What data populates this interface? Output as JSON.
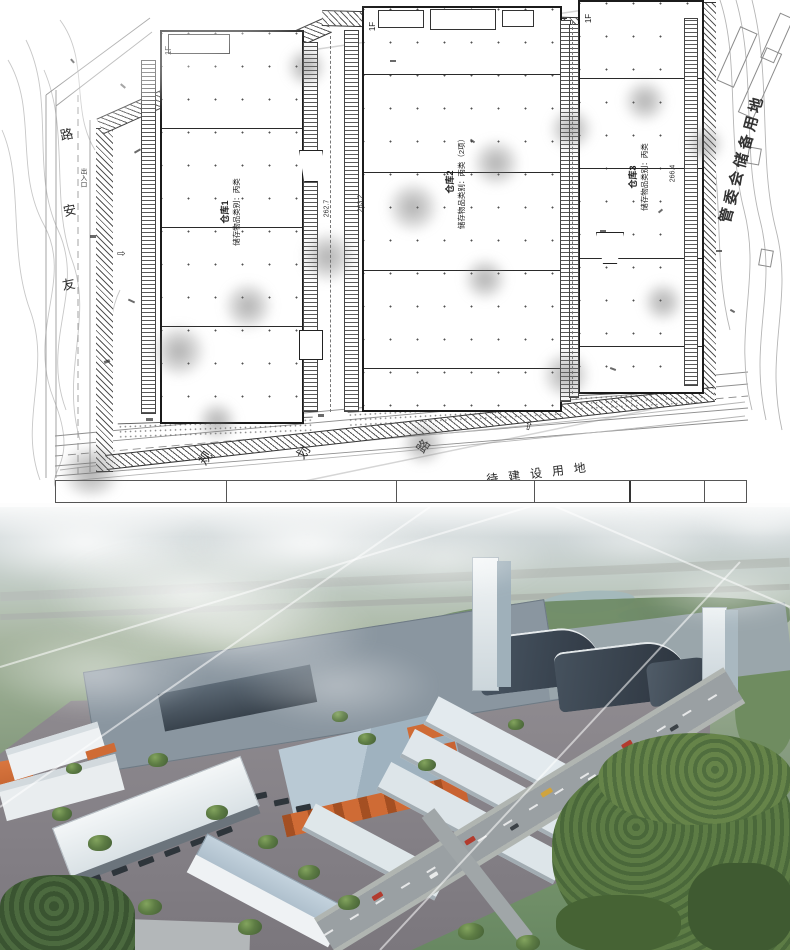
{
  "site_plan": {
    "left_road": {
      "char_top": "路",
      "char_mid": "安",
      "char_bottom": "友",
      "entrance_label": "出入口"
    },
    "planned_road": {
      "char_1": "规",
      "char_2": "划",
      "char_3": "路"
    },
    "pending_land_label": "待建设用地",
    "reserve_land_label": "管委会储备用地",
    "buildings": [
      {
        "floor_label": "1F",
        "name": "仓库1",
        "category": "储存物品类别：丙类",
        "dim": "262.7"
      },
      {
        "floor_label": "1F",
        "name": "仓库2",
        "category": "储存物品类别：丙类（2项）",
        "dim": "263.2"
      },
      {
        "floor_label": "1F",
        "name": "仓库3",
        "category": "储存物品类别：丙类",
        "dim": "266.4"
      }
    ]
  },
  "render_colors": {
    "accent_orange": "#cf6b35",
    "roof_gray": "#9fb2bd",
    "dark_hall": "#39424c",
    "forest_green": "#4e6e3c",
    "road_gray": "#9aa1a4",
    "water": "#a4b9bb"
  }
}
